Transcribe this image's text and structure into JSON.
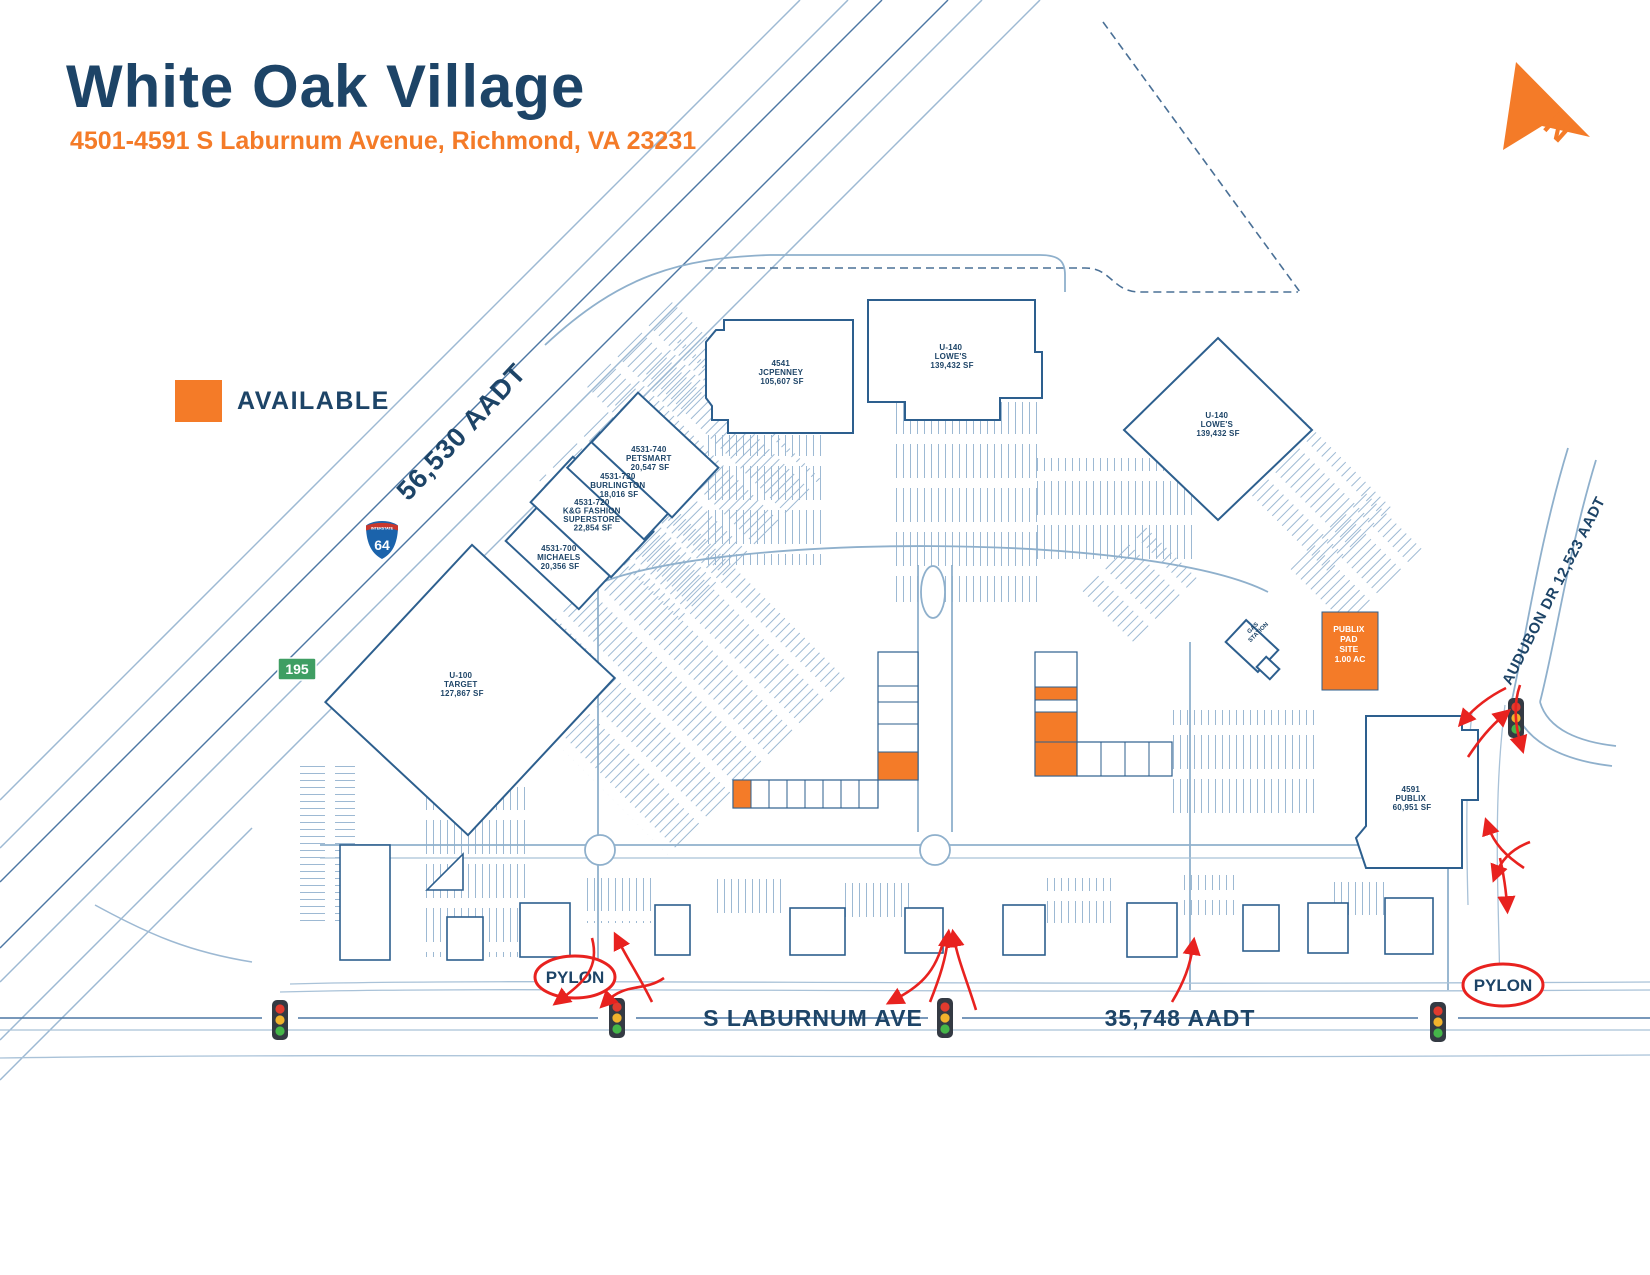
{
  "header": {
    "title": "White Oak Village",
    "subtitle": "4501-4591 S Laburnum Avenue, Richmond, VA 23231"
  },
  "legend": {
    "available_label": "AVAILABLE",
    "available_color": "#F47B28"
  },
  "north_arrow": {
    "label": "N"
  },
  "roads": {
    "interstate_caption": "INTERSTATE",
    "interstate_number": "64",
    "route_number": "195",
    "highway_aadt": "56,530 AADT",
    "street_name": "S LABURNUM AVE",
    "street_aadt": "35,748 AADT",
    "audubon_label": "AUDUBON DR 12,523 AADT"
  },
  "site": {
    "pylon_label": "PYLON",
    "gas_station_line1": "GAS",
    "gas_station_line2": "STATION",
    "buildings": [
      {
        "name": "jcpenney",
        "lines": [
          "4541",
          "JCPENNEY",
          "105,607 SF"
        ]
      },
      {
        "name": "lowes-main",
        "lines": [
          "U-140",
          "LOWE'S",
          "139,432 SF"
        ]
      },
      {
        "name": "lowes-east",
        "lines": [
          "U-140",
          "LOWE'S",
          "139,432 SF"
        ]
      },
      {
        "name": "petsmart",
        "lines": [
          "4531-740",
          "PETSMART",
          "20,547 SF"
        ]
      },
      {
        "name": "burlington",
        "lines": [
          "4531-730",
          "BURLINGTON",
          "18,016 SF"
        ]
      },
      {
        "name": "kg-fashion",
        "lines": [
          "4531-720",
          "K&G FASHION",
          "SUPERSTORE",
          "22,854 SF"
        ]
      },
      {
        "name": "michaels",
        "lines": [
          "4531-700",
          "MICHAELS",
          "20,356 SF"
        ]
      },
      {
        "name": "target",
        "lines": [
          "U-100",
          "TARGET",
          "127,867 SF"
        ]
      },
      {
        "name": "publix",
        "lines": [
          "4591",
          "PUBLIX",
          "60,951 SF"
        ]
      }
    ],
    "available_pad": {
      "lines": [
        "PUBLIX",
        "PAD",
        "SITE",
        "1.00 AC"
      ]
    }
  }
}
